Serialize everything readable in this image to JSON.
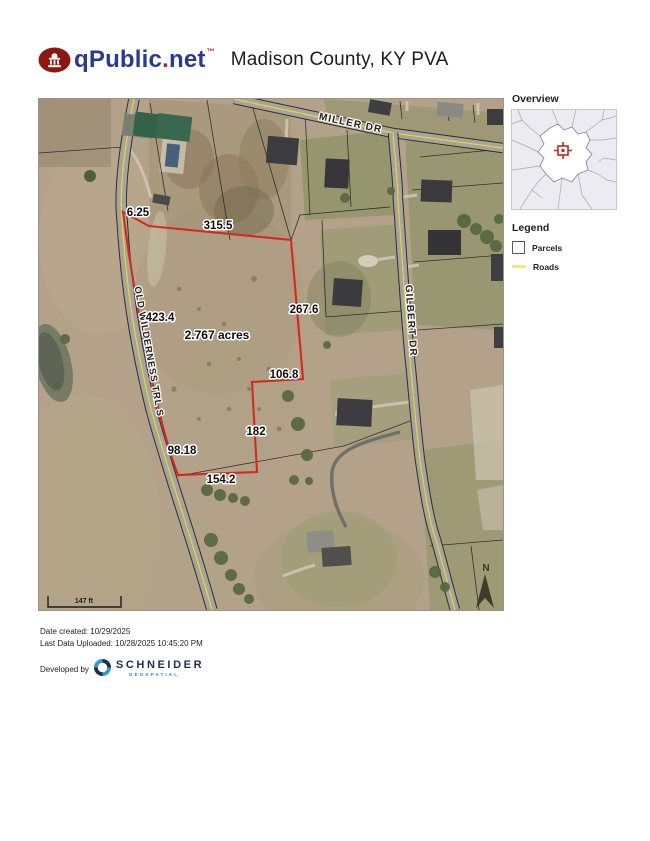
{
  "header": {
    "brand_q": "qPublic",
    "brand_dot": ".",
    "brand_net": "net",
    "trademark": "™",
    "title": "Madison County, KY PVA"
  },
  "map": {
    "roads": [
      {
        "name": "MILLER DR"
      },
      {
        "name": "OLD WILDERNESS TRL S"
      },
      {
        "name": "GILBERT DR"
      }
    ],
    "parcel": {
      "acreage_label": "2.767 acres",
      "dimensions": [
        "6.25",
        "315.5",
        "423.4",
        "267.6",
        "106.8",
        "182",
        "98.18",
        "154.2"
      ],
      "outline_color": "#d42a1e"
    },
    "scale_bar": {
      "label": "147 ft"
    },
    "north_arrow_label": "N",
    "road_centerline_color": "#e8d23e"
  },
  "sidebar": {
    "overview_title": "Overview",
    "legend_title": "Legend",
    "legend_items": [
      {
        "label": "Parcels"
      },
      {
        "label": "Roads"
      }
    ],
    "marker_color": "#c0281e"
  },
  "footer": {
    "date_created": "Date created: 10/29/2025",
    "last_uploaded": "Last Data Uploaded: 10/28/2025 10:45:20 PM",
    "developed_by": "Developed by",
    "vendor_name": "SCHNEIDER",
    "vendor_sub": "GEOSPATIAL"
  }
}
